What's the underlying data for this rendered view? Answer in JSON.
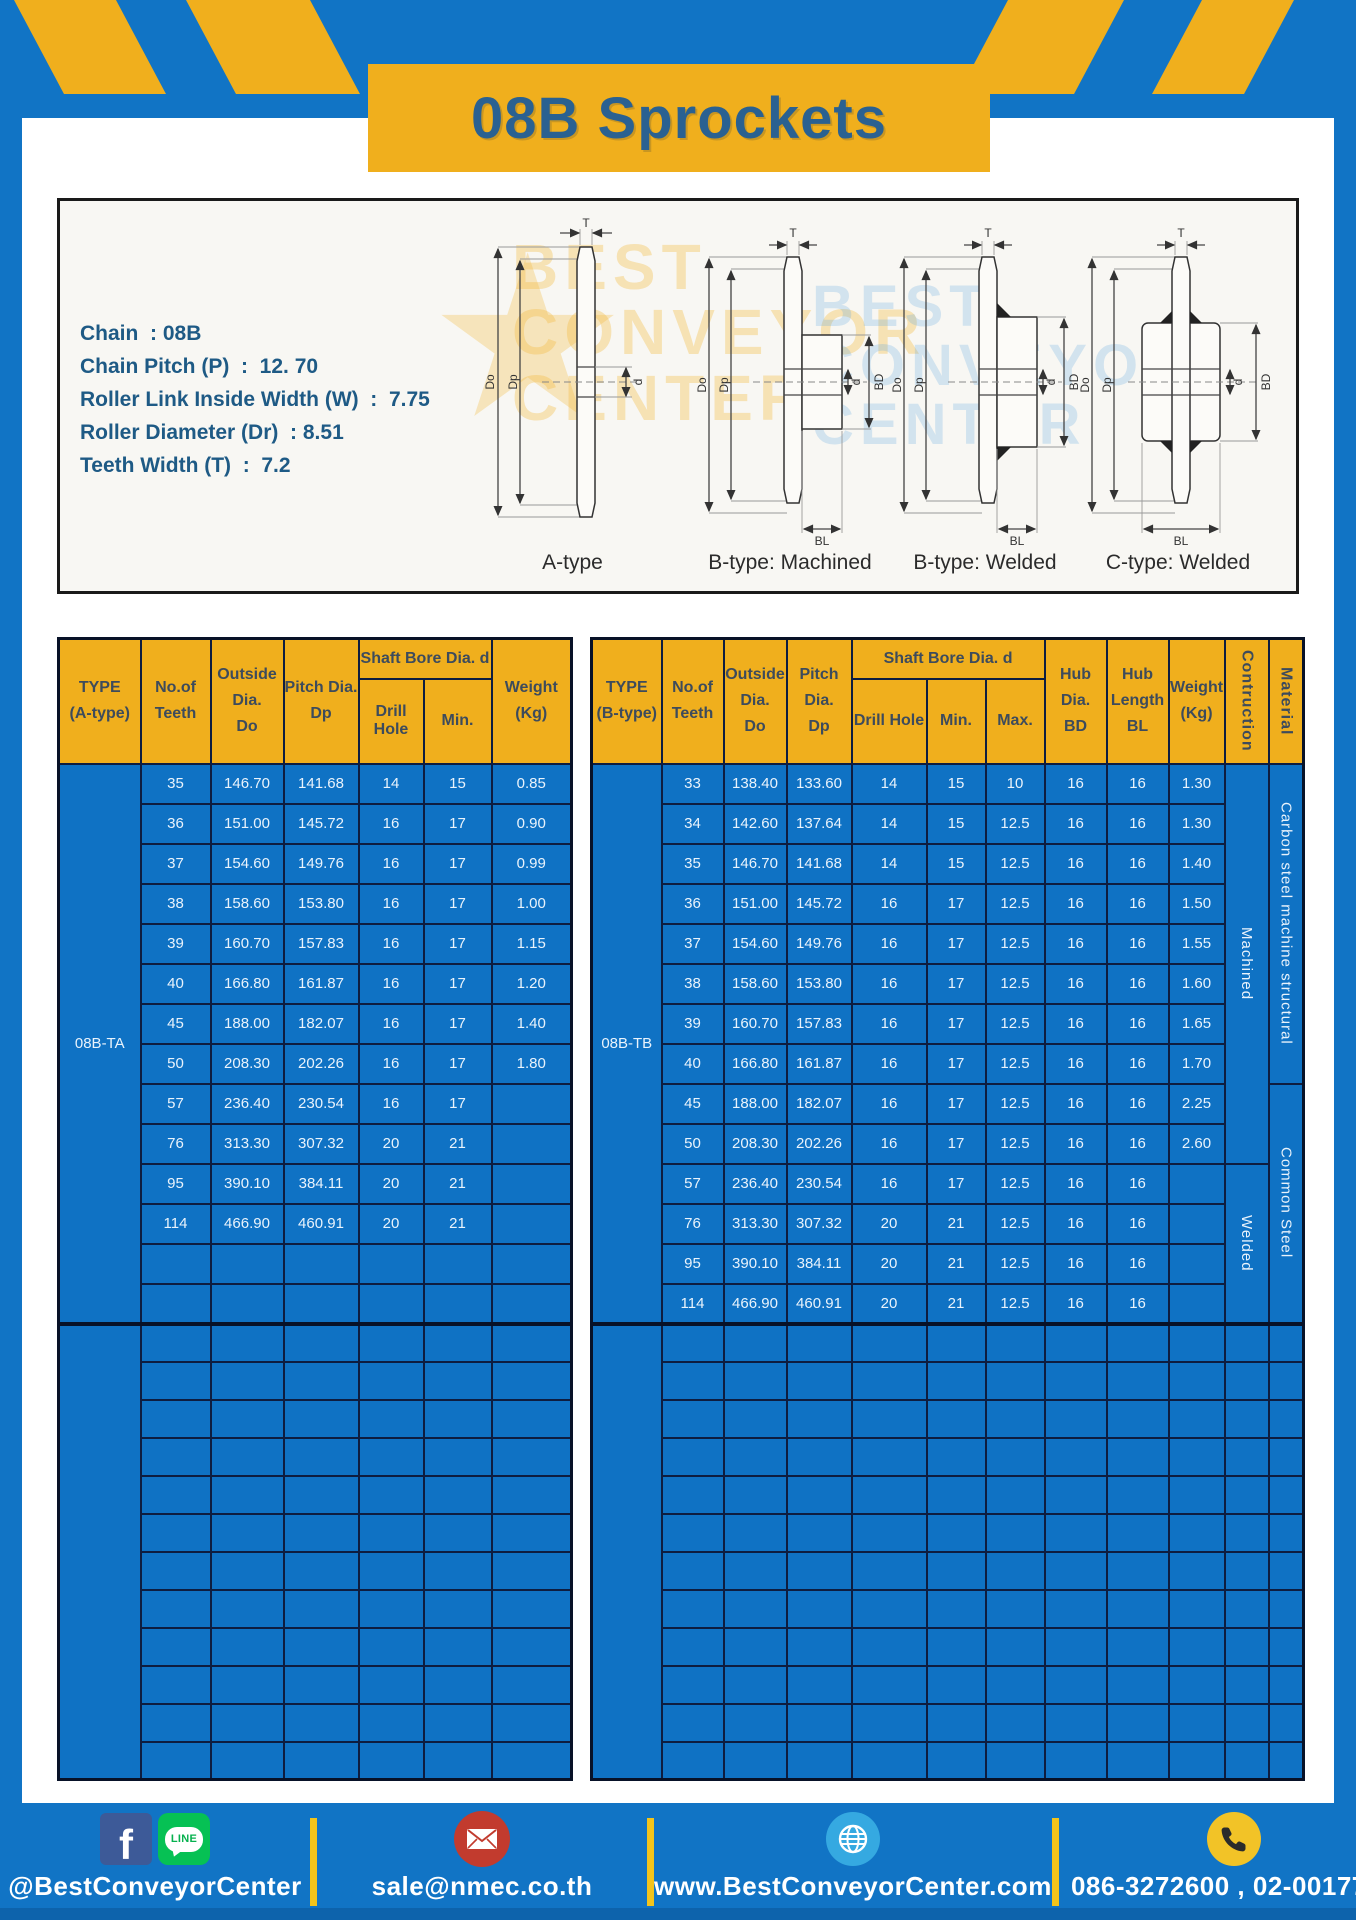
{
  "page": {
    "title": "08B Sprockets"
  },
  "specs": {
    "lines": [
      "Chain  : 08B",
      "Chain Pitch (P)  :  12. 70",
      "Roller Link Inside Width (W)  :  7.75",
      "Roller Diameter (Dr)  : 8.51",
      "Teeth Width (T)  :  7.2"
    ]
  },
  "watermark": {
    "lines": [
      "BEST",
      "CONVEYOR",
      "CENTER"
    ],
    "star": "★"
  },
  "diagrams": {
    "captions": [
      "A-type",
      "B-type: Machined",
      "B-type: Welded",
      "C-type: Welded"
    ],
    "labels": {
      "t": "T",
      "outer": "Do",
      "pitch": "Dp",
      "bore": "d",
      "hub_dia": "BD",
      "hub_len": "BL"
    }
  },
  "tables": {
    "left": {
      "header": {
        "type": [
          "TYPE",
          "(A-type)"
        ],
        "teeth": [
          "No.of",
          "Teeth"
        ],
        "outside": [
          "Outside",
          "Dia.",
          "Do"
        ],
        "pitch": [
          "Pitch Dia.",
          "Dp"
        ],
        "shaft_bore": "Shaft Bore Dia. d",
        "drill_hole": "Drill Hole",
        "min": "Min.",
        "weight": [
          "Weight",
          "(Kg)"
        ]
      },
      "type_label": "08B-TA",
      "rows": [
        [
          "35",
          "146.70",
          "141.68",
          "14",
          "15",
          "0.85"
        ],
        [
          "36",
          "151.00",
          "145.72",
          "16",
          "17",
          "0.90"
        ],
        [
          "37",
          "154.60",
          "149.76",
          "16",
          "17",
          "0.99"
        ],
        [
          "38",
          "158.60",
          "153.80",
          "16",
          "17",
          "1.00"
        ],
        [
          "39",
          "160.70",
          "157.83",
          "16",
          "17",
          "1.15"
        ],
        [
          "40",
          "166.80",
          "161.87",
          "16",
          "17",
          "1.20"
        ],
        [
          "45",
          "188.00",
          "182.07",
          "16",
          "17",
          "1.40"
        ],
        [
          "50",
          "208.30",
          "202.26",
          "16",
          "17",
          "1.80"
        ],
        [
          "57",
          "236.40",
          "230.54",
          "16",
          "17",
          ""
        ],
        [
          "76",
          "313.30",
          "307.32",
          "20",
          "21",
          ""
        ],
        [
          "95",
          "390.10",
          "384.11",
          "20",
          "21",
          ""
        ],
        [
          "114",
          "466.90",
          "460.91",
          "20",
          "21",
          ""
        ]
      ],
      "blank_rows": 2,
      "empty_rows": 12
    },
    "right": {
      "header": {
        "type": [
          "TYPE",
          "(B-type)"
        ],
        "teeth": [
          "No.of",
          "Teeth"
        ],
        "outside": [
          "Outside",
          "Dia.",
          "Do"
        ],
        "pitch": [
          "Pitch Dia.",
          "Dp"
        ],
        "shaft_bore": "Shaft Bore Dia. d",
        "drill_hole": "Drill Hole",
        "min": "Min.",
        "max": "Max.",
        "hub_dia": [
          "Hub Dia.",
          "BD"
        ],
        "hub_len": [
          "Hub",
          "Length",
          "BL"
        ],
        "weight": [
          "Weight",
          "(Kg)"
        ],
        "construction": "Contruction",
        "material": "Material"
      },
      "type_label": "08B-TB",
      "rows": [
        [
          "33",
          "138.40",
          "133.60",
          "14",
          "15",
          "10",
          "16",
          "16",
          "1.30"
        ],
        [
          "34",
          "142.60",
          "137.64",
          "14",
          "15",
          "12.5",
          "16",
          "16",
          "1.30"
        ],
        [
          "35",
          "146.70",
          "141.68",
          "14",
          "15",
          "12.5",
          "16",
          "16",
          "1.40"
        ],
        [
          "36",
          "151.00",
          "145.72",
          "16",
          "17",
          "12.5",
          "16",
          "16",
          "1.50"
        ],
        [
          "37",
          "154.60",
          "149.76",
          "16",
          "17",
          "12.5",
          "16",
          "16",
          "1.55"
        ],
        [
          "38",
          "158.60",
          "153.80",
          "16",
          "17",
          "12.5",
          "16",
          "16",
          "1.60"
        ],
        [
          "39",
          "160.70",
          "157.83",
          "16",
          "17",
          "12.5",
          "16",
          "16",
          "1.65"
        ],
        [
          "40",
          "166.80",
          "161.87",
          "16",
          "17",
          "12.5",
          "16",
          "16",
          "1.70"
        ],
        [
          "45",
          "188.00",
          "182.07",
          "16",
          "17",
          "12.5",
          "16",
          "16",
          "2.25"
        ],
        [
          "50",
          "208.30",
          "202.26",
          "16",
          "17",
          "12.5",
          "16",
          "16",
          "2.60"
        ],
        [
          "57",
          "236.40",
          "230.54",
          "16",
          "17",
          "12.5",
          "16",
          "16",
          ""
        ],
        [
          "76",
          "313.30",
          "307.32",
          "20",
          "21",
          "12.5",
          "16",
          "16",
          ""
        ],
        [
          "95",
          "390.10",
          "384.11",
          "20",
          "21",
          "12.5",
          "16",
          "16",
          ""
        ],
        [
          "114",
          "466.90",
          "460.91",
          "20",
          "21",
          "12.5",
          "16",
          "16",
          ""
        ]
      ],
      "construction_groups": [
        {
          "label": "Machined",
          "span": 10
        },
        {
          "label": "Welded",
          "span": 4
        }
      ],
      "material_groups": [
        {
          "label": "Carbon steel  machine structural",
          "span": 8
        },
        {
          "label": "Common Steel",
          "span": 6
        }
      ],
      "empty_rows": 12
    }
  },
  "footer": {
    "facebook_label": "f",
    "line_label": "LINE",
    "facebook_line_text": "@BestConveyorCenter",
    "email": "sale@nmec.co.th",
    "website": "www.BestConveyorCenter.com",
    "phone": "086-3272600 , 02-0017766"
  },
  "colors": {
    "brand_blue": "#1174C5",
    "brand_yellow": "#F0AF1D",
    "table_blue": "#0F72C4",
    "border_navy": "#0E1D40",
    "title_text": "#2A6191",
    "header_text": "#3D4B5C",
    "spec_text": "#1E5A85",
    "footer_text": "#FFFFFF"
  }
}
